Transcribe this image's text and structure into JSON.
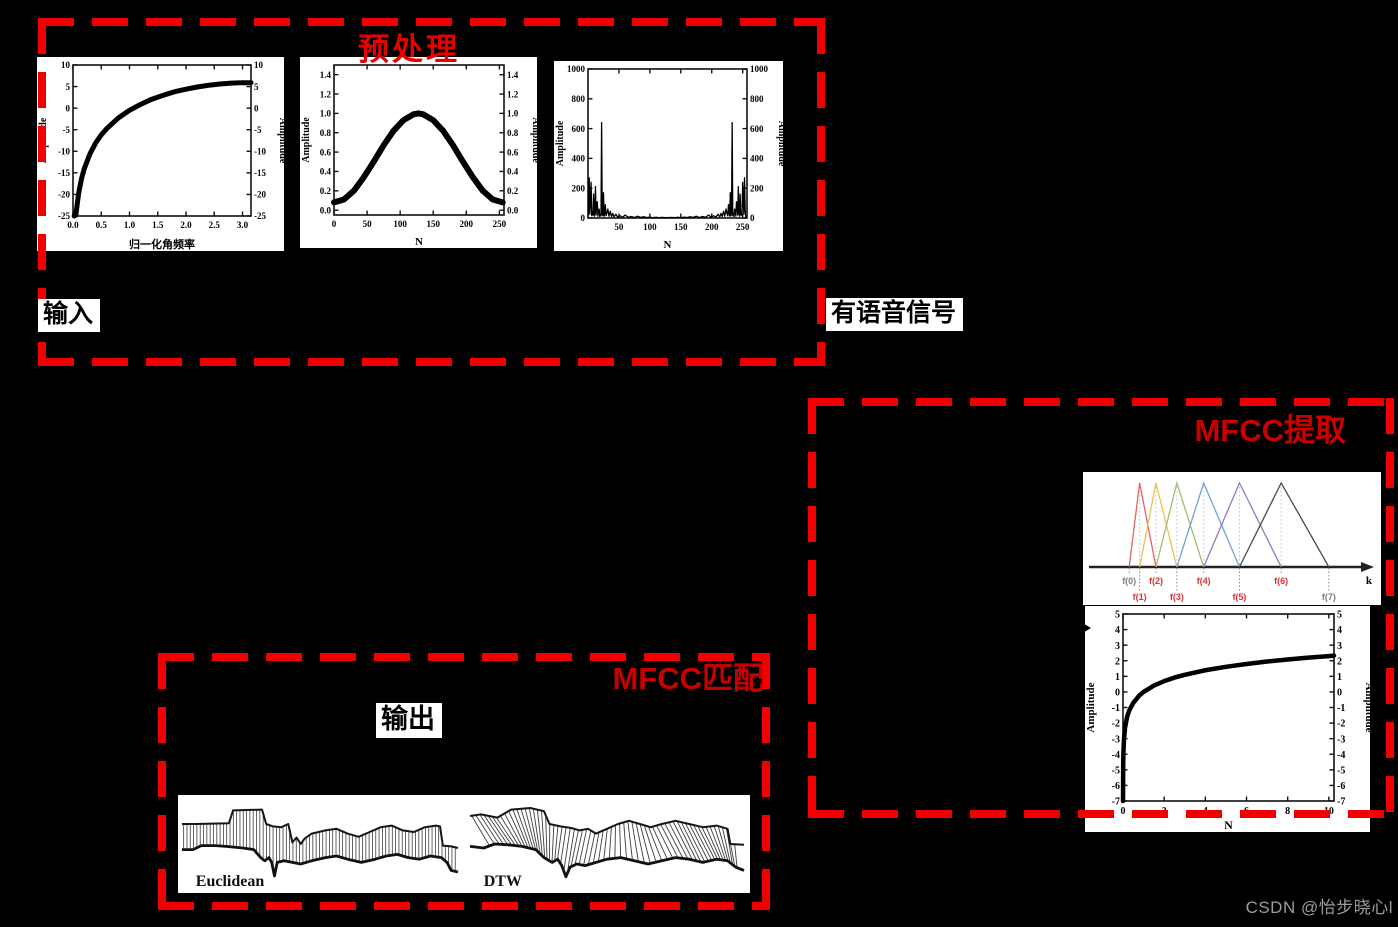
{
  "page": {
    "background": "#000000",
    "watermark": "CSDN @怡步晓心l"
  },
  "colors": {
    "box_border": "#f20000",
    "title_preprocess": "#e60000",
    "title_mfcc": "#c90000",
    "label_bg": "#ffffff",
    "label_text": "#000000",
    "watermark_text": "#9c9c9c"
  },
  "boxes": {
    "preprocess": {
      "title": "预处理"
    },
    "mfcc_extract": {
      "title": "MFCC提取"
    },
    "mfcc_match": {
      "title": "MFCC匹配"
    }
  },
  "labels": {
    "input": "输入",
    "speech": "有语音信号",
    "output": "输出"
  },
  "chart_data": [
    {
      "id": "preemphasis",
      "type": "line",
      "title": "",
      "xlabel": "归一化角频率",
      "ylabel": "Amplitude",
      "xlim": [
        0,
        3.15
      ],
      "ylim": [
        -25,
        10
      ],
      "xticks": [
        "0.0",
        "0.5",
        "1.0",
        "1.5",
        "2.0",
        "2.5",
        "3.0"
      ],
      "yticks": [
        "10",
        "5",
        "0",
        "-5",
        "-10",
        "-15",
        "-20",
        "-25"
      ],
      "points": [
        [
          0.02,
          -25
        ],
        [
          0.05,
          -24.8
        ],
        [
          0.1,
          -19.7
        ],
        [
          0.15,
          -16.4
        ],
        [
          0.2,
          -14.0
        ],
        [
          0.3,
          -10.6
        ],
        [
          0.4,
          -8.1
        ],
        [
          0.5,
          -6.2
        ],
        [
          0.6,
          -4.7
        ],
        [
          0.8,
          -2.3
        ],
        [
          1.0,
          -0.5
        ],
        [
          1.2,
          0.9
        ],
        [
          1.4,
          2.1
        ],
        [
          1.6,
          3.0
        ],
        [
          1.8,
          3.8
        ],
        [
          2.0,
          4.4
        ],
        [
          2.2,
          4.9
        ],
        [
          2.4,
          5.3
        ],
        [
          2.6,
          5.6
        ],
        [
          2.8,
          5.8
        ],
        [
          3.0,
          5.9
        ],
        [
          3.15,
          5.9
        ]
      ]
    },
    {
      "id": "hamming",
      "type": "line",
      "title": "",
      "xlabel": "N",
      "ylabel": "Amplitude",
      "xlim": [
        0,
        257
      ],
      "ylim": [
        -0.05,
        1.5
      ],
      "xticks": [
        "0",
        "50",
        "100",
        "150",
        "200",
        "250"
      ],
      "yticks": [
        "0.0",
        "0.2",
        "0.4",
        "0.6",
        "0.8",
        "1.0",
        "1.2",
        "1.4"
      ],
      "points": [
        [
          0,
          0.08
        ],
        [
          15,
          0.11
        ],
        [
          30,
          0.2
        ],
        [
          45,
          0.34
        ],
        [
          60,
          0.5
        ],
        [
          75,
          0.67
        ],
        [
          90,
          0.82
        ],
        [
          105,
          0.93
        ],
        [
          120,
          0.99
        ],
        [
          128,
          1.0
        ],
        [
          135,
          0.99
        ],
        [
          150,
          0.93
        ],
        [
          165,
          0.82
        ],
        [
          180,
          0.67
        ],
        [
          195,
          0.5
        ],
        [
          210,
          0.34
        ],
        [
          225,
          0.2
        ],
        [
          240,
          0.11
        ],
        [
          255,
          0.08
        ]
      ]
    },
    {
      "id": "fft",
      "type": "line",
      "title": "",
      "xlabel": "N",
      "ylabel": "Amplitude",
      "xlim": [
        0,
        257
      ],
      "ylim": [
        0,
        1000
      ],
      "xticks": [
        "50",
        "100",
        "150",
        "200",
        "250"
      ],
      "yticks": [
        "0",
        "200",
        "400",
        "600",
        "800",
        "1000"
      ],
      "mirror_x": 255,
      "points": [
        [
          0,
          5
        ],
        [
          1,
          60
        ],
        [
          2,
          270
        ],
        [
          3,
          25
        ],
        [
          4,
          120
        ],
        [
          5,
          240
        ],
        [
          6,
          15
        ],
        [
          7,
          40
        ],
        [
          8,
          20
        ],
        [
          9,
          160
        ],
        [
          10,
          12
        ],
        [
          11,
          30
        ],
        [
          12,
          210
        ],
        [
          13,
          20
        ],
        [
          14,
          80
        ],
        [
          15,
          110
        ],
        [
          16,
          12
        ],
        [
          17,
          40
        ],
        [
          18,
          60
        ],
        [
          19,
          10
        ],
        [
          20,
          25
        ],
        [
          21,
          15
        ],
        [
          22,
          640
        ],
        [
          23,
          30
        ],
        [
          24,
          15
        ],
        [
          25,
          170
        ],
        [
          26,
          12
        ],
        [
          27,
          40
        ],
        [
          28,
          90
        ],
        [
          29,
          15
        ],
        [
          30,
          25
        ],
        [
          32,
          60
        ],
        [
          34,
          12
        ],
        [
          36,
          45
        ],
        [
          38,
          10
        ],
        [
          40,
          30
        ],
        [
          42,
          8
        ],
        [
          45,
          25
        ],
        [
          48,
          6
        ],
        [
          52,
          15
        ],
        [
          56,
          4
        ],
        [
          60,
          20
        ],
        [
          65,
          5
        ],
        [
          70,
          10
        ],
        [
          75,
          3
        ],
        [
          80,
          12
        ],
        [
          85,
          4
        ],
        [
          90,
          8
        ],
        [
          95,
          3
        ],
        [
          100,
          6
        ],
        [
          105,
          2
        ],
        [
          110,
          5
        ],
        [
          115,
          2
        ],
        [
          120,
          4
        ],
        [
          125,
          2
        ],
        [
          128,
          3
        ]
      ]
    },
    {
      "id": "filterbank",
      "type": "filterbank",
      "title": "",
      "axis_label": "k",
      "f_labels": [
        "f(0)",
        "f(1)",
        "f(2)",
        "f(3)",
        "f(4)",
        "f(5)",
        "f(6)",
        "f(7)"
      ],
      "f_positions": [
        0.155,
        0.19,
        0.245,
        0.315,
        0.405,
        0.525,
        0.665,
        0.825
      ],
      "f_label_colors": [
        "#7d7d7d",
        "#e63030",
        "#e63030",
        "#e63030",
        "#e63030",
        "#e63030",
        "#e63030",
        "#7d7d7d"
      ],
      "triangle_colors": [
        "#e06464",
        "#edc24e",
        "#9fc168",
        "#6fa3d7",
        "#9579c2",
        "#4a4a4a"
      ]
    },
    {
      "id": "logcurve",
      "type": "line",
      "title": "",
      "xlabel": "N",
      "ylabel": "Amplitude",
      "xlim": [
        0,
        10.25
      ],
      "ylim": [
        -7,
        5
      ],
      "xticks": [
        "0",
        "2",
        "4",
        "6",
        "8",
        "10"
      ],
      "yticks": [
        "5",
        "4",
        "3",
        "2",
        "1",
        "0",
        "-1",
        "-2",
        "-3",
        "-4",
        "-5",
        "-6",
        "-7"
      ],
      "points": [
        [
          0.001,
          -7
        ],
        [
          0.01,
          -4.6
        ],
        [
          0.02,
          -3.9
        ],
        [
          0.05,
          -3.0
        ],
        [
          0.1,
          -2.3
        ],
        [
          0.2,
          -1.6
        ],
        [
          0.3,
          -1.2
        ],
        [
          0.5,
          -0.7
        ],
        [
          0.8,
          -0.22
        ],
        [
          1,
          0
        ],
        [
          1.5,
          0.41
        ],
        [
          2,
          0.69
        ],
        [
          2.5,
          0.92
        ],
        [
          3,
          1.1
        ],
        [
          4,
          1.39
        ],
        [
          5,
          1.61
        ],
        [
          6,
          1.79
        ],
        [
          7,
          1.95
        ],
        [
          8,
          2.08
        ],
        [
          9,
          2.2
        ],
        [
          10,
          2.3
        ],
        [
          10.25,
          2.33
        ]
      ]
    },
    {
      "id": "alignment",
      "type": "alignment",
      "title": "",
      "panels": [
        {
          "label": "Euclidean",
          "hatch": "vertical",
          "top": [
            [
              0.0,
              0.3
            ],
            [
              0.05,
              0.3
            ],
            [
              0.17,
              0.29
            ],
            [
              0.185,
              0.13
            ],
            [
              0.29,
              0.12
            ],
            [
              0.305,
              0.3
            ],
            [
              0.33,
              0.33
            ],
            [
              0.36,
              0.34
            ],
            [
              0.385,
              0.3
            ],
            [
              0.4,
              0.53
            ],
            [
              0.415,
              0.47
            ],
            [
              0.43,
              0.55
            ],
            [
              0.445,
              0.48
            ],
            [
              0.47,
              0.42
            ],
            [
              0.52,
              0.38
            ],
            [
              0.56,
              0.36
            ],
            [
              0.6,
              0.42
            ],
            [
              0.64,
              0.46
            ],
            [
              0.68,
              0.4
            ],
            [
              0.72,
              0.34
            ],
            [
              0.76,
              0.32
            ],
            [
              0.8,
              0.38
            ],
            [
              0.84,
              0.4
            ],
            [
              0.88,
              0.34
            ],
            [
              0.92,
              0.32
            ],
            [
              0.935,
              0.33
            ],
            [
              0.945,
              0.57
            ],
            [
              0.975,
              0.58
            ],
            [
              1.0,
              0.6
            ]
          ],
          "bottom": [
            [
              0.0,
              0.62
            ],
            [
              0.04,
              0.62
            ],
            [
              0.07,
              0.57
            ],
            [
              0.12,
              0.57
            ],
            [
              0.16,
              0.58
            ],
            [
              0.22,
              0.6
            ],
            [
              0.26,
              0.62
            ],
            [
              0.285,
              0.72
            ],
            [
              0.3,
              0.76
            ],
            [
              0.315,
              0.72
            ],
            [
              0.325,
              0.78
            ],
            [
              0.335,
              0.95
            ],
            [
              0.345,
              0.78
            ],
            [
              0.37,
              0.76
            ],
            [
              0.4,
              0.78
            ],
            [
              0.43,
              0.8
            ],
            [
              0.47,
              0.76
            ],
            [
              0.52,
              0.72
            ],
            [
              0.56,
              0.7
            ],
            [
              0.6,
              0.74
            ],
            [
              0.65,
              0.78
            ],
            [
              0.7,
              0.74
            ],
            [
              0.74,
              0.7
            ],
            [
              0.78,
              0.68
            ],
            [
              0.82,
              0.72
            ],
            [
              0.86,
              0.74
            ],
            [
              0.9,
              0.7
            ],
            [
              0.94,
              0.72
            ],
            [
              0.96,
              0.78
            ],
            [
              0.975,
              0.88
            ],
            [
              1.0,
              0.9
            ]
          ]
        },
        {
          "label": "DTW",
          "hatch": "slanted",
          "top": [
            [
              0.0,
              0.2
            ],
            [
              0.04,
              0.18
            ],
            [
              0.1,
              0.22
            ],
            [
              0.15,
              0.12
            ],
            [
              0.22,
              0.1
            ],
            [
              0.27,
              0.14
            ],
            [
              0.29,
              0.3
            ],
            [
              0.33,
              0.33
            ],
            [
              0.37,
              0.35
            ],
            [
              0.4,
              0.38
            ],
            [
              0.43,
              0.36
            ],
            [
              0.46,
              0.42
            ],
            [
              0.5,
              0.36
            ],
            [
              0.54,
              0.3
            ],
            [
              0.58,
              0.26
            ],
            [
              0.62,
              0.3
            ],
            [
              0.66,
              0.34
            ],
            [
              0.7,
              0.3
            ],
            [
              0.75,
              0.26
            ],
            [
              0.8,
              0.3
            ],
            [
              0.85,
              0.34
            ],
            [
              0.9,
              0.32
            ],
            [
              0.94,
              0.36
            ],
            [
              0.95,
              0.55
            ],
            [
              1.0,
              0.56
            ]
          ],
          "bottom": [
            [
              0.0,
              0.58
            ],
            [
              0.05,
              0.6
            ],
            [
              0.09,
              0.55
            ],
            [
              0.14,
              0.56
            ],
            [
              0.19,
              0.58
            ],
            [
              0.24,
              0.62
            ],
            [
              0.27,
              0.72
            ],
            [
              0.3,
              0.78
            ],
            [
              0.32,
              0.74
            ],
            [
              0.335,
              0.82
            ],
            [
              0.35,
              0.96
            ],
            [
              0.365,
              0.84
            ],
            [
              0.39,
              0.8
            ],
            [
              0.42,
              0.82
            ],
            [
              0.46,
              0.78
            ],
            [
              0.5,
              0.74
            ],
            [
              0.55,
              0.72
            ],
            [
              0.6,
              0.76
            ],
            [
              0.65,
              0.8
            ],
            [
              0.7,
              0.76
            ],
            [
              0.75,
              0.72
            ],
            [
              0.8,
              0.74
            ],
            [
              0.85,
              0.78
            ],
            [
              0.9,
              0.74
            ],
            [
              0.94,
              0.76
            ],
            [
              0.97,
              0.84
            ],
            [
              1.0,
              0.88
            ]
          ]
        }
      ]
    }
  ]
}
